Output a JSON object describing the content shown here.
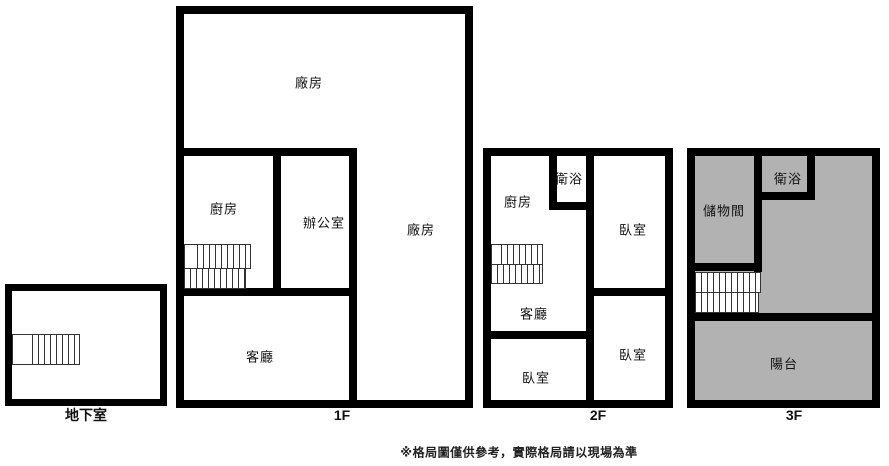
{
  "title": "floor-plan-diagram",
  "colors": {
    "wall": "#000000",
    "floor_white": "#ffffff",
    "floor_gray": "#b2b2b2",
    "stair_line": "#333333",
    "text": "#111111"
  },
  "floors": [
    {
      "id": "basement",
      "caption": "地下室",
      "rooms": []
    },
    {
      "id": "1f",
      "caption": "1F",
      "rooms": [
        {
          "name": "factory-main",
          "label": "廠房"
        },
        {
          "name": "kitchen",
          "label": "廚房"
        },
        {
          "name": "office",
          "label": "辦公室"
        },
        {
          "name": "factory-side",
          "label": "廠房"
        },
        {
          "name": "living-room",
          "label": "客廳"
        }
      ]
    },
    {
      "id": "2f",
      "caption": "2F",
      "rooms": [
        {
          "name": "kitchen",
          "label": "廚房"
        },
        {
          "name": "bathroom",
          "label": "衛浴"
        },
        {
          "name": "bedroom-upper-right",
          "label": "臥室"
        },
        {
          "name": "living-room",
          "label": "客廳"
        },
        {
          "name": "bedroom-lower-left",
          "label": "臥室"
        },
        {
          "name": "bedroom-lower-right",
          "label": "臥室"
        }
      ]
    },
    {
      "id": "3f",
      "caption": "3F",
      "rooms": [
        {
          "name": "storage-room",
          "label": "儲物間"
        },
        {
          "name": "bathroom",
          "label": "衛浴"
        },
        {
          "name": "balcony",
          "label": "陽台"
        }
      ]
    }
  ],
  "footer_note": "※格局圖僅供參考，實際格局請以現場為準"
}
